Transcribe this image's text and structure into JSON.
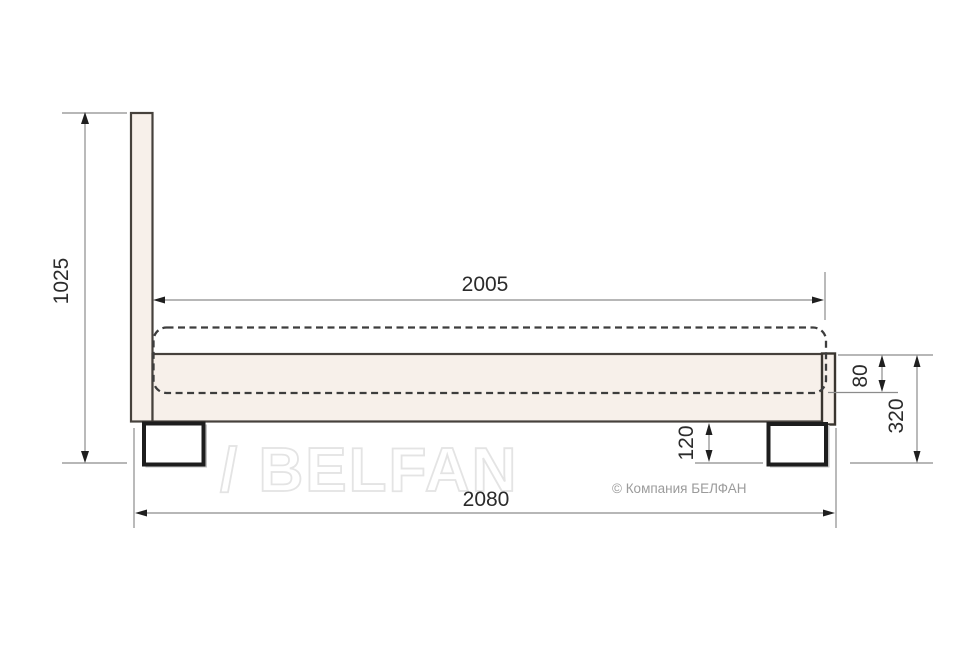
{
  "drawing": {
    "type": "bed-side-view-technical-drawing",
    "dimension_labels": {
      "total_height": "1025",
      "mattress_length": "2005",
      "overall_length": "2080",
      "rail_height": "80",
      "base_height": "320",
      "leg_height": "120"
    },
    "colors": {
      "panel_fill": "#f7f0ea",
      "panel_outline": "#46413c",
      "leg_outline": "#1d1d1d",
      "dimension_line": "#8c8c8c",
      "dimension_text": "#2b2b2b",
      "watermark_stroke": "#e4e4e4",
      "copyright_text": "#9b9b9b"
    }
  },
  "watermark": {
    "text": "/ BELFAN"
  },
  "footer": {
    "copyright": "© Компания БЕЛФАН"
  }
}
